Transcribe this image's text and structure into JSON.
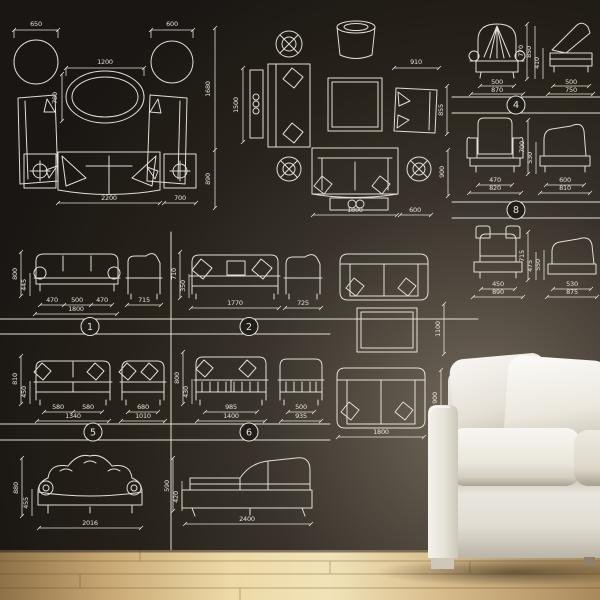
{
  "scene": {
    "description": "Black wall covered with white CAD furniture blueprint decals, a real white sofa on a wooden floor at bottom right",
    "wall_color": "#242019",
    "line_color": "#ece9e0",
    "floor_light": "#f1e3b8",
    "floor_dark": "#8e7148",
    "sofa_color": "#f3f1ec"
  },
  "cad": {
    "plan_left": {
      "ottoman_left_w": "650",
      "ottoman_right_w": "600",
      "table_w": "1200",
      "table_d": "780",
      "layout_d": "1680",
      "sofa_d": "890",
      "sofa_w": "2200",
      "side_table_w": "700"
    },
    "plan_mid": {
      "seat_l": "1500",
      "armchair_w": "910",
      "armchair_d": "855",
      "sofa_w": "1800",
      "side_table_w": "600",
      "sofa_d": "900"
    },
    "mid_column": {
      "table_w": "1100",
      "sofa_w": "1800",
      "sofa_d": "900"
    },
    "elev_col": {
      "s1": {
        "h": "770",
        "side_h": "850",
        "side_seat_h": "410",
        "seat_w": "500",
        "total_w": "870",
        "side_seat_w": "500",
        "side_total_w": "750",
        "badge": "4"
      },
      "s2": {
        "h": "700",
        "seat_h": "530",
        "seat_w": "470",
        "total_w": "820",
        "side_seat_w": "600",
        "side_total_w": "810",
        "badge": "8"
      },
      "s3": {
        "h": "715",
        "seat_h": "475",
        "side_h": "550",
        "seat_w": "450",
        "total_w": "890",
        "side_seat_w": "530",
        "side_total_w": "875"
      }
    },
    "grid": {
      "r1": {
        "h": "800",
        "seat_h": "445",
        "seg1": "470",
        "seg2": "500",
        "seg3": "470",
        "total_w": "1800",
        "side_w": "715",
        "badge": "1"
      },
      "r2": {
        "h": "710",
        "seat_h": "350",
        "total_w": "1770",
        "side_w": "725",
        "badge": "2"
      },
      "r3": {
        "h": "810",
        "seat_h": "450",
        "seg1": "580",
        "seg2": "580",
        "total_w": "1340",
        "chair_seat_w": "680",
        "chair_total_w": "1010",
        "badge": "5"
      },
      "r4": {
        "h": "800",
        "seat_h": "430",
        "seat_w": "985",
        "total_w": "1400",
        "chair_seat_w": "500",
        "chair_total_w": "935",
        "badge": "6"
      },
      "b1": {
        "total_w": "2016",
        "h": "880",
        "seat_h": "455"
      },
      "b2": {
        "total_w": "2400",
        "h": "590",
        "seat_h": "420"
      }
    }
  }
}
